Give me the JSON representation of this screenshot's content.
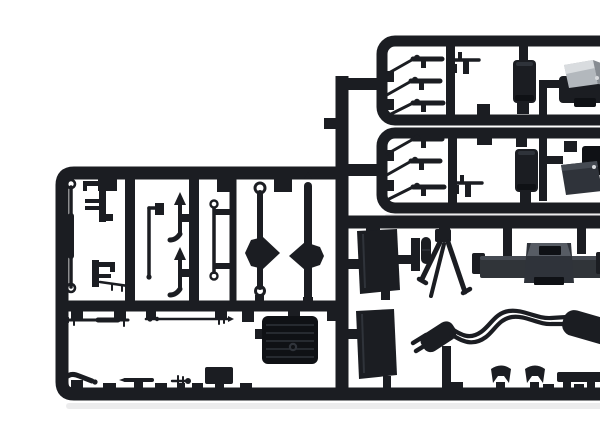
{
  "meta": {
    "title": "Black plastic model-kit sprue photographed on white background",
    "description": "Injection-molded parts tree: two small accessory runners (top right) holding rifles, a machine gun, canisters and cab panels; one large stepped runner holding axles with differentials, springs, levers, tie rods, a battery box, pedals, two seats, a machine-gun tripod, a transfer case and an exhaust system with two mufflers."
  },
  "colors": {
    "background": "#ffffff",
    "plastic": "#1b1d22",
    "plasticDark": "#0f1115",
    "plasticMid": "#2f333a",
    "plasticLight": "#454a52",
    "silverLight": "#d9dcdf",
    "silverMid": "#b3b8bd",
    "silverDark": "#878c92",
    "grayPart": "#303439",
    "grayPartLight": "#575c64",
    "highlightDot": "#d8dadd",
    "shadow": "#b9bcc0"
  },
  "parts": {
    "sprue_main": "main sprue frame",
    "sprue_sub_top": "upper accessory runner",
    "sprue_sub_bottom": "lower accessory runner",
    "connector_runner": "connecting runner",
    "rifles_top": "rifle parts, upper runner",
    "rifles_bottom": "rifle parts, lower runner",
    "machine_gun_top": "machine gun part, upper runner",
    "machine_gun_bottom": "machine gun part, lower runner",
    "canister_top": "canister part, upper runner",
    "canister_bottom": "canister part, lower runner",
    "cab_panel_silver": "silver cab panel part",
    "cab_panel_dark": "dark cab panel part",
    "leaf_spring": "spring rod with eyelets",
    "chassis_bracket_upper": "chassis bracket part",
    "chassis_bracket_lower": "chassis bracket with link rod",
    "exhaust_pipe_small": "elbow pipe part",
    "gear_levers": "gear lever parts",
    "link_rod": "link rod with eyelets",
    "front_axle": "axle with differential, left",
    "rear_axle": "axle with differential, right",
    "tie_rod_left": "tie rod part, left",
    "tie_rod_right": "tie rod part, right",
    "battery_box": "ribbed battery box part",
    "pedals": "pedal and small lever parts",
    "seat_upper": "seat back part, upper",
    "seat_lower": "seat back part, lower",
    "tripod": "machine-gun tripod part",
    "pump_part": "small canister and bracket parts",
    "transfer_case": "transfer case / engine part",
    "exhaust_system": "exhaust line with front and rear mufflers",
    "clamps": "saddle clamp parts",
    "mount_bracket": "mounting bracket part"
  }
}
